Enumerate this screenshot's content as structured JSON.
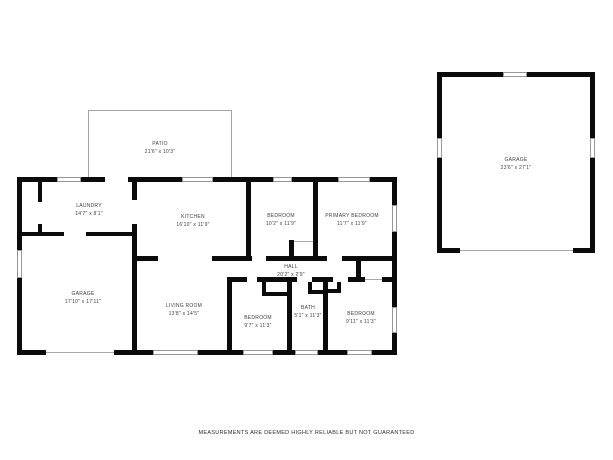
{
  "page": {
    "footer_disclaimer": "MEASUREMENTS ARE DEEMED HIGHLY RELIABLE BUT NOT GUARANTEED"
  },
  "colors": {
    "wall": "#0b0b0b",
    "patio_outline": "#a2a2a2",
    "window_outline": "#979797",
    "label_text": "#3e3e3e",
    "background": "#ffffff"
  },
  "rooms": {
    "patio": {
      "name": "PATIO",
      "dims": "21'6\" x 10'3\""
    },
    "laundry": {
      "name": "LAUNDRY",
      "dims": "14'7\" x 8'1\""
    },
    "kitchen": {
      "name": "KITCHEN",
      "dims": "16'10\" x 11'9\""
    },
    "bedroom_top": {
      "name": "BEDROOM",
      "dims": "10'2\" x 11'9\""
    },
    "primary_bedroom": {
      "name": "PRIMARY BEDROOM",
      "dims": "11'7\" x 11'9\""
    },
    "garage_attached": {
      "name": "GARAGE",
      "dims": "17'10\" x 17'11\""
    },
    "living_room": {
      "name": "LIVING ROOM",
      "dims": "13'8\" x 14'5\""
    },
    "hall": {
      "name": "HALL",
      "dims": "20'2\" x 2'9\""
    },
    "bedroom_left": {
      "name": "BEDROOM",
      "dims": "9'7\" x 11'3\""
    },
    "bath": {
      "name": "BATH",
      "dims": "5'1\" x 11'3\""
    },
    "bedroom_right": {
      "name": "BEDROOM",
      "dims": "9'11\" x 11'3\""
    },
    "garage_detached": {
      "name": "GARAGE",
      "dims": "23'6\" x 27'1\""
    }
  }
}
